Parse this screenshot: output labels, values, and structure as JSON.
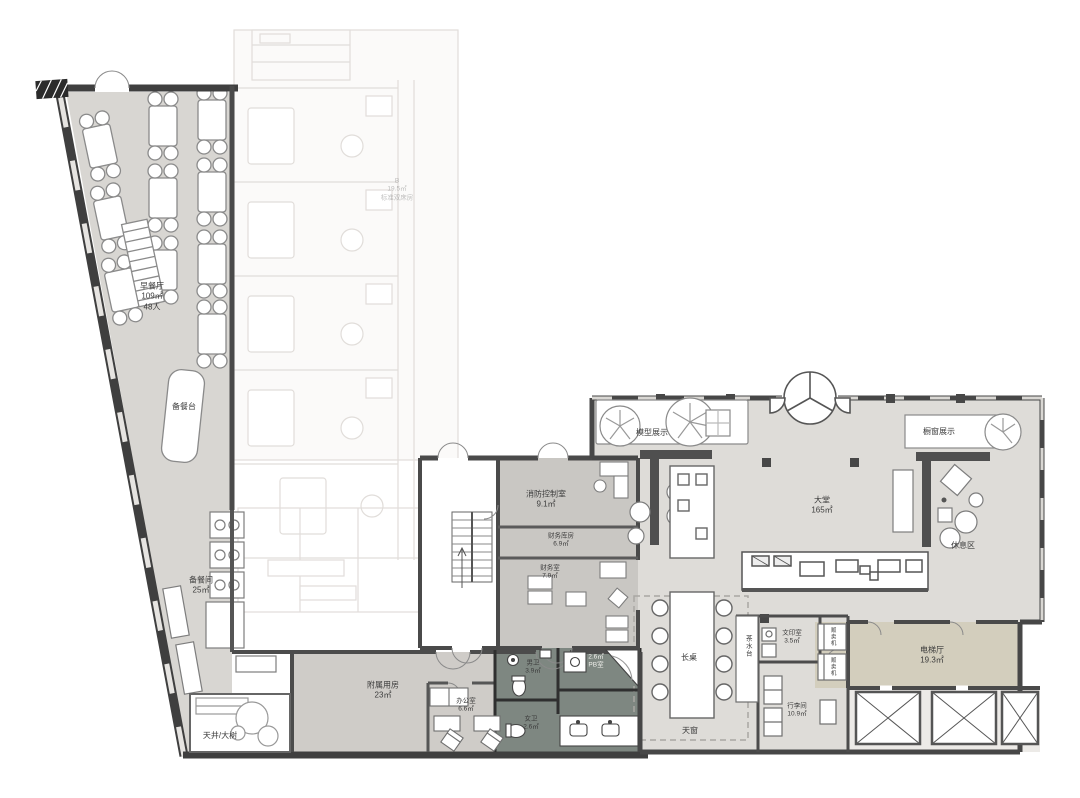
{
  "plan": {
    "type": "hotel-ground-floor-plan",
    "colors": {
      "wall": "#3f3f3f",
      "floor_wing": "#d8d6d2",
      "floor_service": "#cfccc8",
      "floor_lobby": "#dedcd8",
      "floor_bath": "#7e8781",
      "floor_elevator_hall": "#d3cebd",
      "ghost": "#dcd8d4"
    },
    "rooms": {
      "breakfast": {
        "name": "早餐厅",
        "area": "109㎡",
        "capacity": "48人"
      },
      "serving_counter": {
        "name": "备餐台"
      },
      "pantry": {
        "name": "备餐间",
        "area": "25㎡"
      },
      "ancillary": {
        "name": "附属用房",
        "area": "23㎡"
      },
      "office": {
        "name": "办公室",
        "area": "6.6㎡"
      },
      "mens_toilet": {
        "name": "男卫",
        "area": "3.9㎡"
      },
      "womens_toilet": {
        "name": "女卫",
        "area": "2.6㎡"
      },
      "pb_room": {
        "area": "2.6㎡",
        "name": "PB室"
      },
      "fire_control": {
        "name": "消防控制室",
        "area": "9.1㎡"
      },
      "finance_storage": {
        "name": "财务库房",
        "area": "6.9㎡"
      },
      "finance_office": {
        "name": "财务室",
        "area": "7.9㎡"
      },
      "lobby": {
        "name": "大堂",
        "area": "165㎡"
      },
      "model_display": {
        "name": "模型展示"
      },
      "window_display": {
        "name": "橱窗展示"
      },
      "lounge": {
        "name": "休息区"
      },
      "tea_station": {
        "name": "茶水台"
      },
      "print_room": {
        "name": "文印室",
        "area": "3.5㎡"
      },
      "vending_machine": {
        "name": "贩卖机"
      },
      "luggage_room": {
        "name": "行李间",
        "area": "10.9㎡"
      },
      "elevator_hall": {
        "name": "电梯厅",
        "area": "19.3㎡"
      },
      "long_table": {
        "name": "长桌"
      },
      "skylight": {
        "name": "天窗"
      },
      "courtyard": {
        "name": "天井/大树"
      },
      "ghost_room": {
        "grade": "B",
        "area": "19.5㎡",
        "room_type": "标准双床房"
      }
    }
  }
}
